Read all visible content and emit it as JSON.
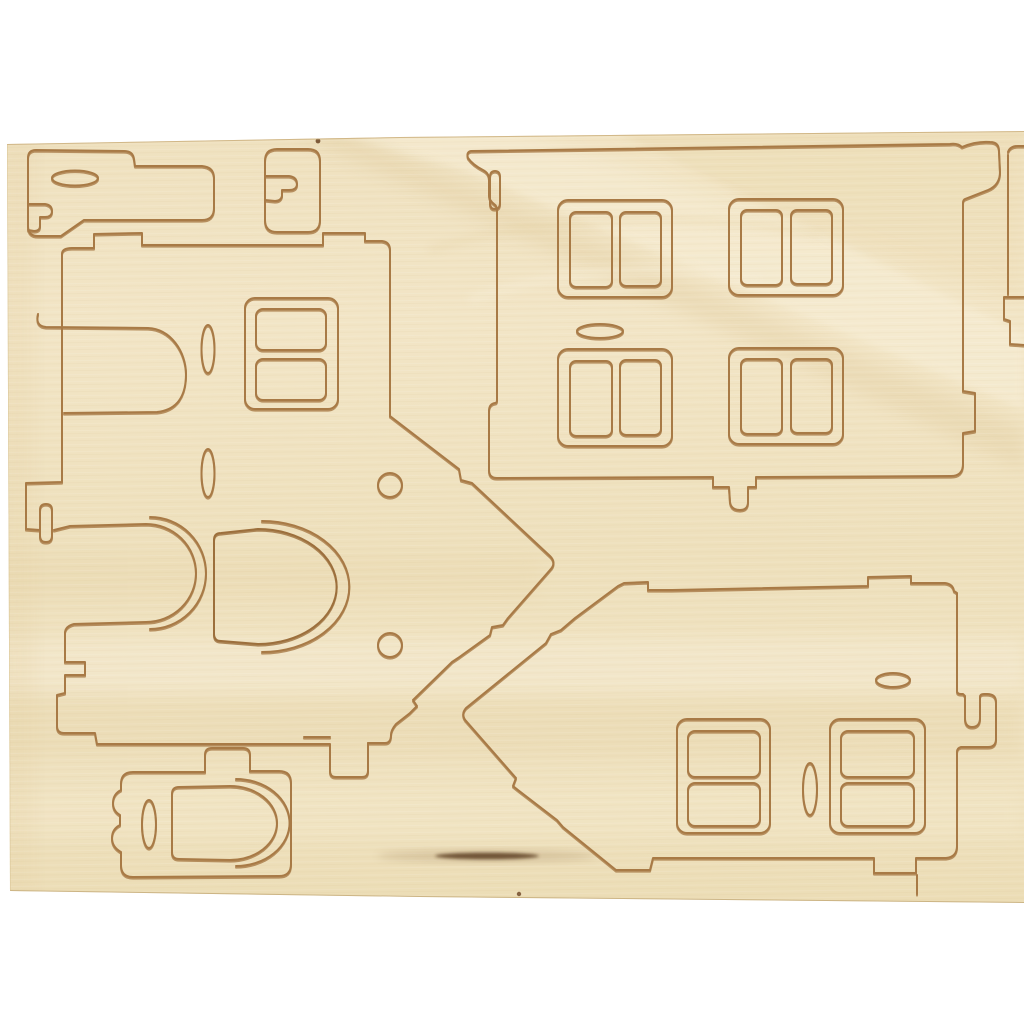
{
  "scene": {
    "description": "Light birch plywood sheet with laser pre-cut puzzle pieces for assembling a miniature 3D house",
    "background_color": "#ffffff",
    "object": "plywood-craft-sheet"
  },
  "palette": {
    "wood_light": "#f4e8ca",
    "wood_mid": "#eddfbc",
    "wood_band_dark": "#e3cfa2",
    "wood_streak_light": "#f8efd8",
    "cut_line": "#a87a46",
    "cut_line_dark": "#8a6132",
    "knot_dark": "#56391d",
    "sheet_edge": "#c9ad79"
  },
  "sheet": {
    "material": "plywood",
    "pieces": [
      {
        "name": "roof-panel-top-left",
        "slots": [
          "horizontal-oval-slot",
          "hook-slot"
        ]
      },
      {
        "name": "small-clip-piece",
        "slots": [
          "hook-slot"
        ]
      },
      {
        "name": "large-front-wall",
        "window_count": 4,
        "panes_per_window": 2,
        "slots": [
          "horizontal-oval-slot",
          "hook-tab-top-right",
          "hanging-hook-bottom",
          "side-slot"
        ]
      },
      {
        "name": "side-wall-with-right-gable",
        "window_count": 1,
        "panes_per_window": 2,
        "features": [
          "arched-door-opening",
          "loose-arched-door-piece",
          "vertical-oval-slot",
          "vertical-oval-slot",
          "peg-hole",
          "peg-hole",
          "notched-roof-edges",
          "interlock-s-curve-cut"
        ]
      },
      {
        "name": "gable-wall-pointing-left",
        "window_count": 2,
        "panes_per_window": 2,
        "features": [
          "horizontal-oval-slot",
          "vertical-oval-slot",
          "hook-tab-right-edge",
          "notched-roof-edges",
          "edge-tabs"
        ]
      },
      {
        "name": "small-base-piece-bottom-left",
        "features": [
          "arched-door-cut",
          "vertical-oval-slot",
          "scalloped-left-edge",
          "top-tab"
        ]
      },
      {
        "name": "edge-strip-right",
        "features": [
          "step-notch"
        ]
      }
    ],
    "marks": [
      "dark-knot-streak-bottom-center",
      "speck-top-edge",
      "speck-bottom-center"
    ]
  }
}
